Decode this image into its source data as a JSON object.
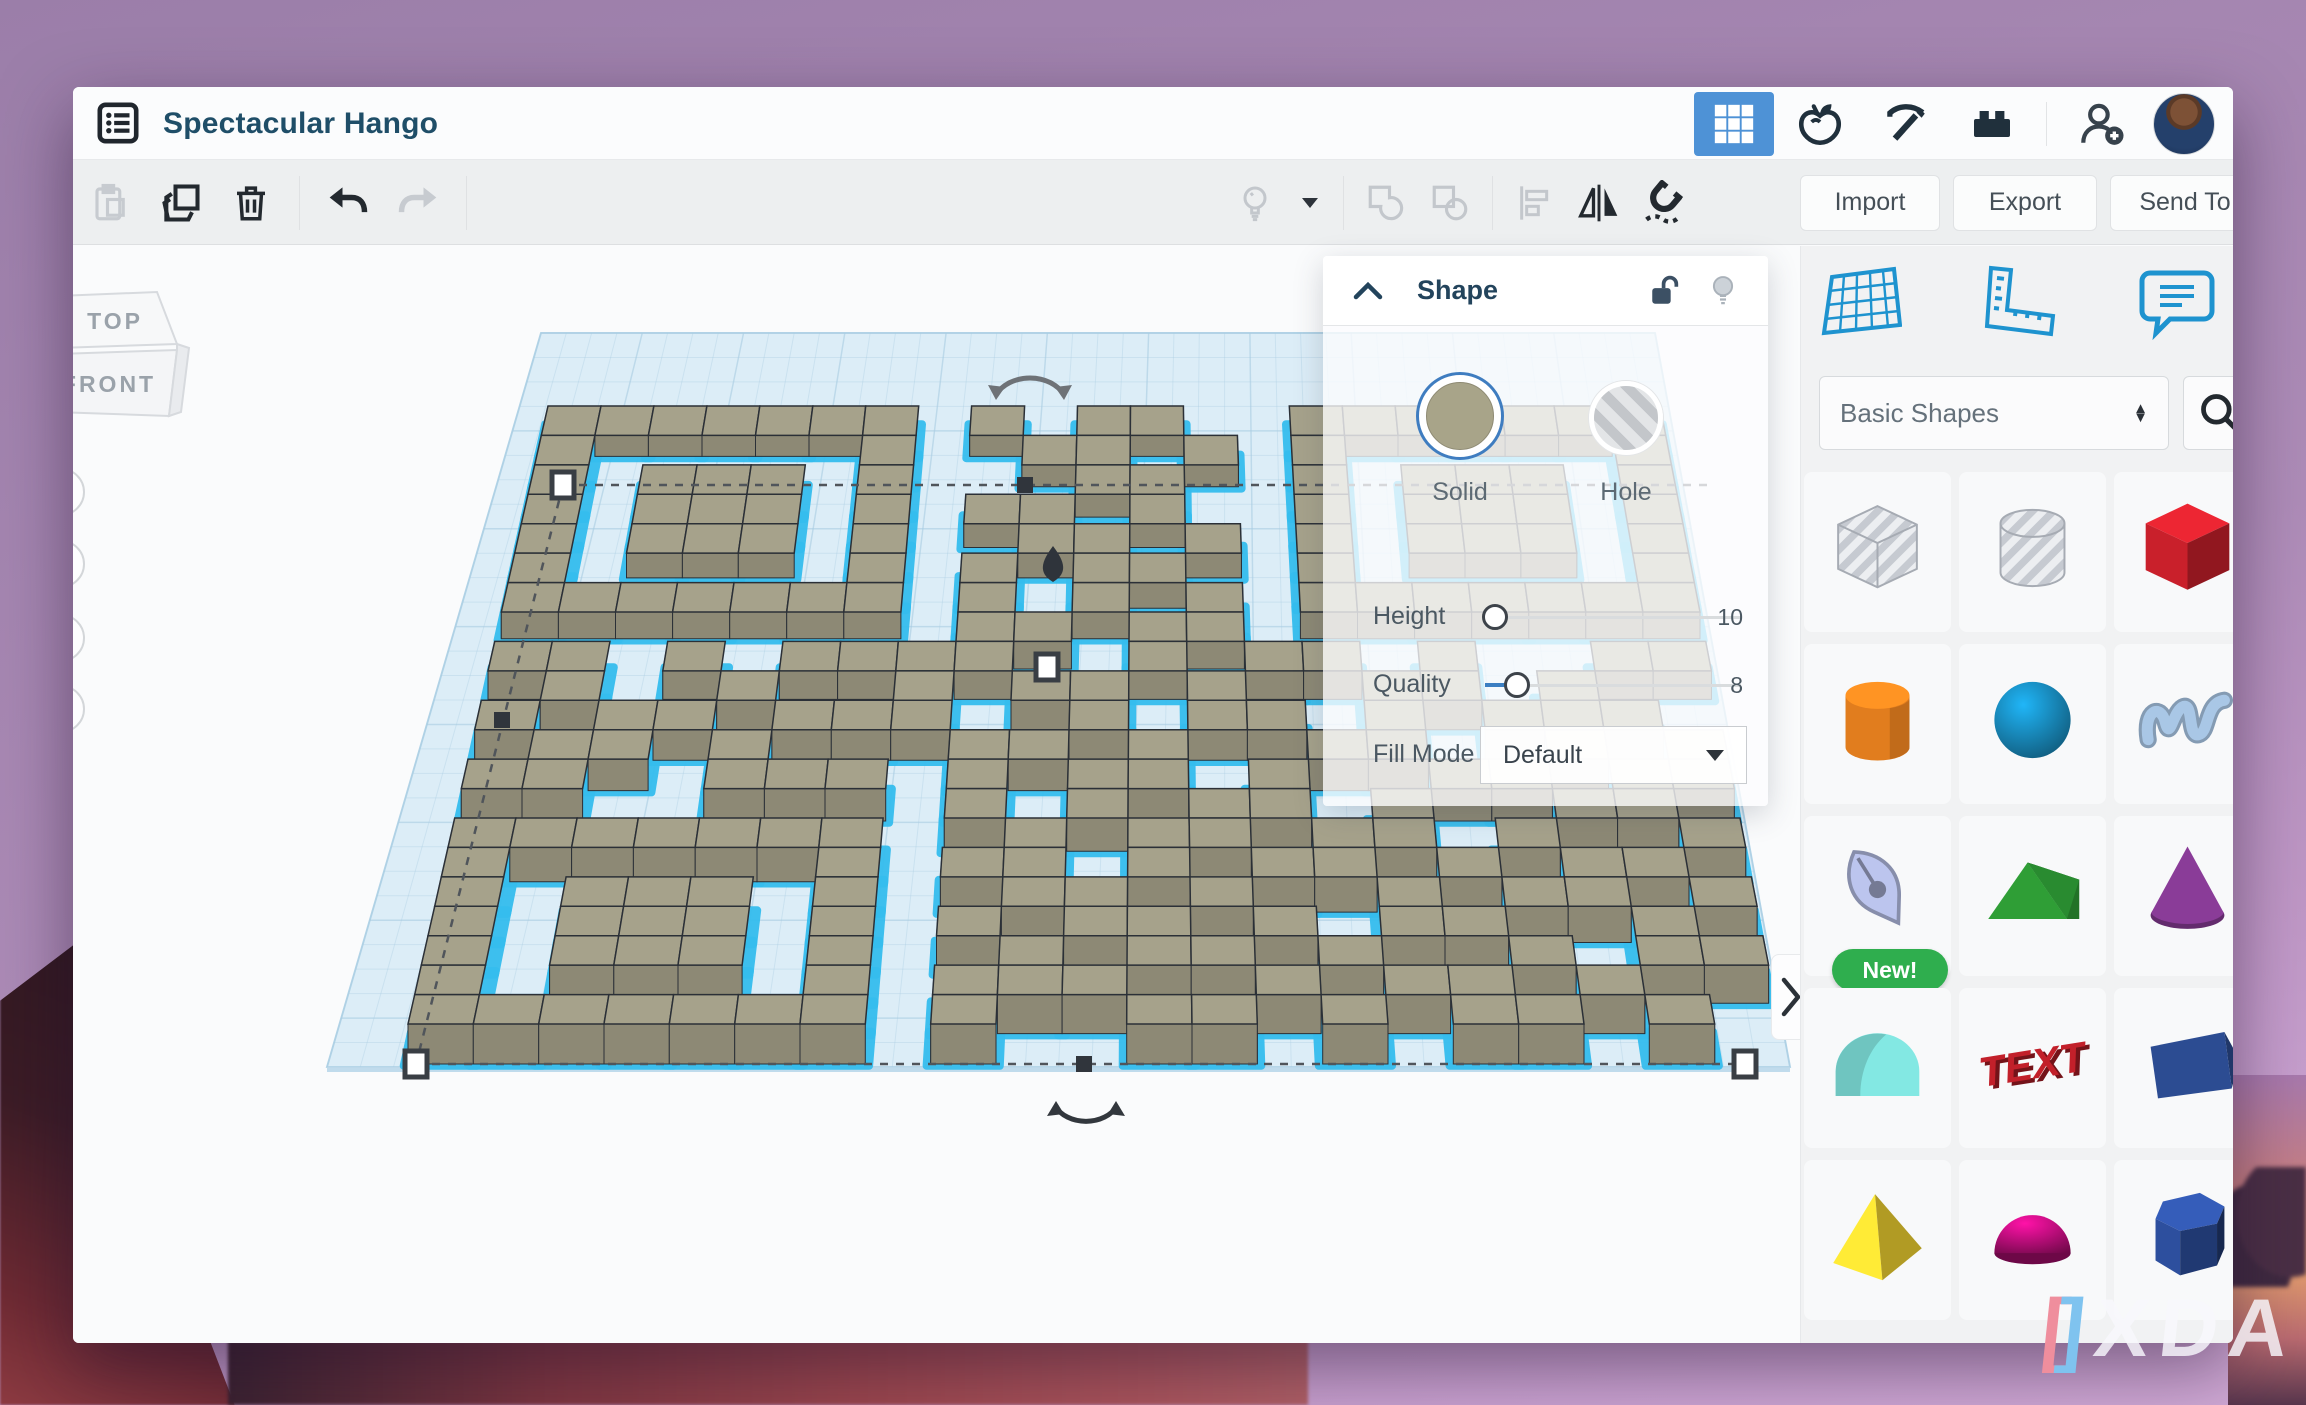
{
  "window": {
    "title": "Spectacular Hango",
    "toolbar": {
      "import_label": "Import",
      "export_label": "Export",
      "send_to_label": "Send To"
    }
  },
  "shape_panel": {
    "title": "Shape",
    "solid_label": "Solid",
    "hole_label": "Hole",
    "rows": {
      "height_label": "Height",
      "height_value": "10",
      "quality_label": "Quality",
      "quality_value": "8",
      "fill_mode_label": "Fill Mode",
      "fill_mode_value": "Default"
    },
    "accent_color": "#3c7fc2",
    "solid_color": "#a8a489"
  },
  "sidebar": {
    "category_selector": "Basic Shapes",
    "new_badge": "New!",
    "shapes": [
      {
        "name": "box-hole",
        "kind": "holebox",
        "color": "#d3d6dc"
      },
      {
        "name": "cylinder-hole",
        "kind": "holecyl",
        "color": "#d3d6dc"
      },
      {
        "name": "box",
        "kind": "box",
        "color": "#c9202b"
      },
      {
        "name": "cylinder",
        "kind": "cylinder",
        "color": "#e17d1e"
      },
      {
        "name": "sphere",
        "kind": "sphere",
        "color": "#1b9ad2"
      },
      {
        "name": "scribble",
        "kind": "scribble",
        "color": "#a9c7e6"
      },
      {
        "name": "sketch",
        "kind": "sketch",
        "color": "#bcc5ee",
        "badge": true
      },
      {
        "name": "roof",
        "kind": "roof",
        "color": "#2f9e36"
      },
      {
        "name": "cone",
        "kind": "cone",
        "color": "#8a3c98"
      },
      {
        "name": "round-roof",
        "kind": "roundroof",
        "color": "#6fc5c0"
      },
      {
        "name": "text",
        "kind": "text",
        "color": "#c2202a",
        "label": "TEXT"
      },
      {
        "name": "wedge",
        "kind": "wedge",
        "color": "#2c4c92"
      },
      {
        "name": "pyramid",
        "kind": "pyramid",
        "color": "#e3c72e"
      },
      {
        "name": "half-sphere",
        "kind": "halfsphere",
        "color": "#d90f8e"
      },
      {
        "name": "polygon",
        "kind": "polygon",
        "color": "#2d4f9e"
      }
    ]
  },
  "viewport": {
    "viewcube_top": "TOP",
    "viewcube_front": "FRONT",
    "colors": {
      "plane": "#dcedf7",
      "grid": "#a9cde2",
      "block_top": "#a6a28b",
      "block_front": "#8d8975",
      "block_west": "#96927d",
      "block_east": "#7e7a66",
      "outline": "#2b3037",
      "selection": "#35bdee"
    },
    "qr_matrix": [
      "111111101011001111111",
      "100000100110101000001",
      "101110100011001011101",
      "101110101101001011101",
      "101110100110101011101",
      "100000101011001000001",
      "111111101010101111111",
      "000000001101100000000",
      "110101111001011010011",
      "010010010110100110100",
      "101101110010110101110",
      "011010001101001100101",
      "110011101011010011011",
      "000000001010110100110",
      "111111100101101101001",
      "100000101101011010110",
      "101110100110100101101",
      "101110101011010110010",
      "101110100101101001011",
      "100000101110010110100",
      "111111101001101011010"
    ]
  },
  "watermark": {
    "bracket_open": "[",
    "bracket_close": "]",
    "text": "XDA"
  }
}
